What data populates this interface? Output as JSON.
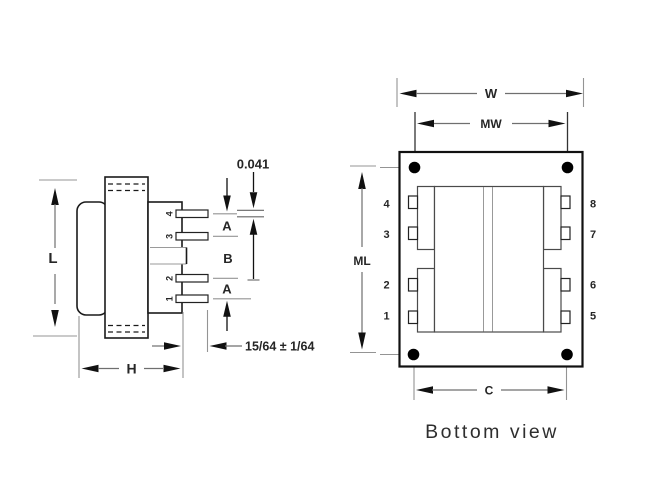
{
  "drawing": {
    "caption": "Bottom view",
    "side_view": {
      "labels": {
        "overall_length": "L",
        "overall_height": "H",
        "pin_pitch_a_top": "A",
        "pin_pitch_b": "B",
        "pin_pitch_a_bottom": "A",
        "pin_thickness": "0.041",
        "pin_length": "15/64 ± 1/64"
      },
      "pin_numbers": [
        "4",
        "3",
        "2",
        "1"
      ]
    },
    "bottom_view": {
      "labels": {
        "overall_width": "W",
        "mounting_width": "MW",
        "mounting_length": "ML",
        "pin_row_spacing": "C"
      },
      "left_pin_numbers": [
        "4",
        "3",
        "2",
        "1"
      ],
      "right_pin_numbers": [
        "8",
        "7",
        "6",
        "5"
      ]
    },
    "colors": {
      "outline": "#1a1a1a",
      "dimension_line": "#6f6f6f",
      "extension_line": "#949494",
      "arrow": "#111111",
      "label": "#262626",
      "background": "#ffffff"
    }
  }
}
